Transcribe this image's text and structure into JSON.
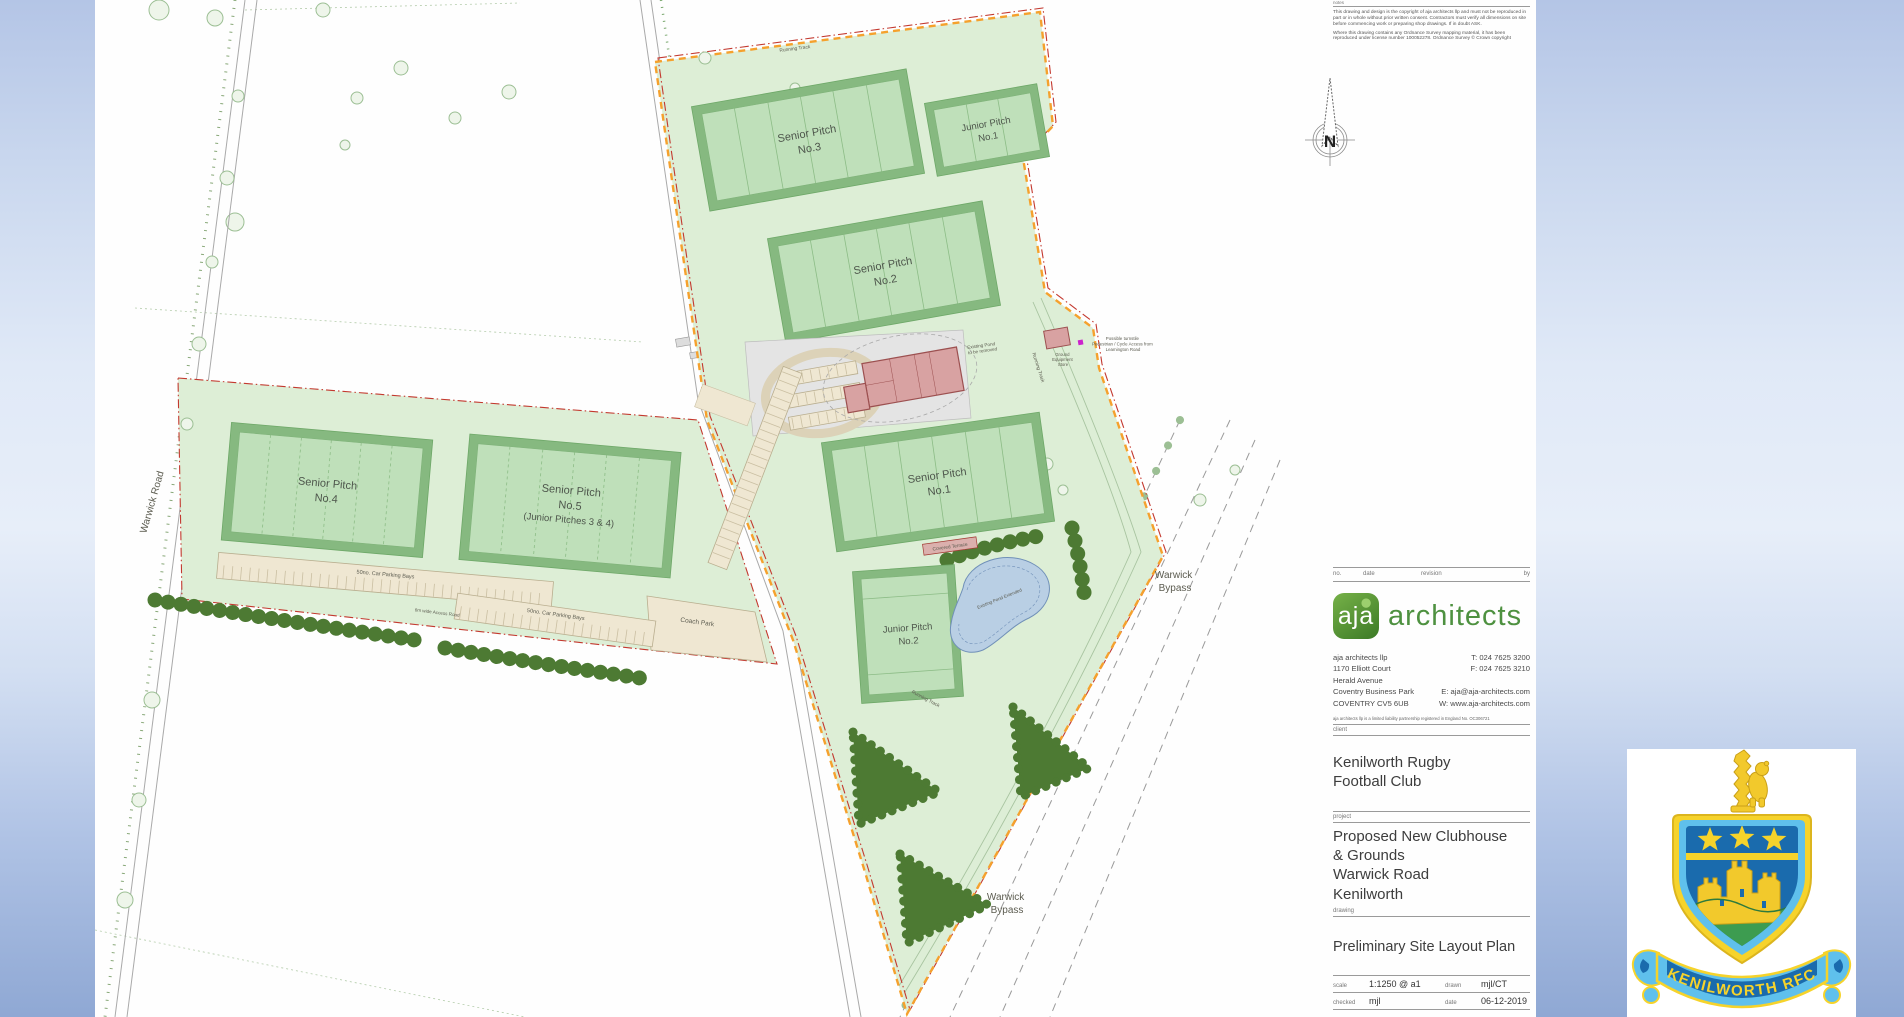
{
  "notes": {
    "label": "notes",
    "para1": "This drawing and design is the copyright of aja architects llp and must not be reproduced in part or in whole without prior written consent. Contractors must verify all dimensions on site before commencing work or preparing shop drawings. If in doubt ASK.",
    "para2": "Where this drawing contains any Ordnance Survey mapping material, it has been reproduced under license number 100052278. Ordnance Survey © Crown copyright"
  },
  "north_label": "N",
  "plan": {
    "pitches": [
      {
        "line1": "Senior Pitch",
        "line2": "No.3"
      },
      {
        "line1": "Junior Pitch",
        "line2": "No.1"
      },
      {
        "line1": "Senior Pitch",
        "line2": "No.2"
      },
      {
        "line1": "Senior Pitch",
        "line2": "No.1"
      },
      {
        "line1": "Junior Pitch",
        "line2": "No.2"
      },
      {
        "line1": "Senior Pitch",
        "line2": "No.4"
      },
      {
        "line1": "Senior Pitch",
        "line2": "No.5",
        "line3": "(Junior Pitches 3 & 4)"
      }
    ],
    "labels": {
      "warwick_road": "Warwick Road",
      "bypass_line1": "Warwick",
      "bypass_line2": "Bypass",
      "coach_park": "Coach Park",
      "parking_bays": "50no. Car Parking Bays",
      "access_road": "6m wide Access Road",
      "running_track": "Running Track",
      "covered_terrace": "Covered Terrace",
      "pond_extended": "Existing Pond Extended",
      "pond_removed_1": "Existing Pond",
      "pond_removed_2": "to be removed",
      "store_1": "Ground",
      "store_2": "Equipment",
      "store_3": "Store",
      "turnstile_1": "Possible turnstile",
      "turnstile_2": "Pedestrian / Cycle Access from",
      "turnstile_3": "Leamington Road"
    }
  },
  "titleblock": {
    "revision": {
      "no": "no.",
      "date": "date",
      "revision": "revision",
      "by": "by"
    },
    "logo": {
      "initials": "aja",
      "name": "architects"
    },
    "address_lines": [
      "aja architects llp",
      "1170 Elliott Court",
      "Herald Avenue",
      "Coventry Business Park",
      "COVENTRY CV5 6UB"
    ],
    "contact_lines": [
      "T: 024 7625 3200",
      "F: 024 7625 3210",
      "",
      "E: aja@aja-architects.com",
      "W: www.aja-architects.com"
    ],
    "registration": "aja architects llp is a limited liability partnership registered in England No. OC306721",
    "client_label": "client",
    "client_line1": "Kenilworth Rugby",
    "client_line2": "Football Club",
    "project_label": "project",
    "project_lines": [
      "Proposed New Clubhouse",
      "& Grounds",
      "Warwick Road",
      "Kenilworth"
    ],
    "drawing_label": "drawing",
    "drawing_title": "Preliminary Site Layout Plan",
    "scale_label": "scale",
    "scale_value": "1:1250 @ a1",
    "drawn_label": "drawn",
    "drawn_value": "mjl/CT",
    "checked_label": "checked",
    "checked_value": "mjl",
    "date_label": "date",
    "date_value": "06-12-2019",
    "no_label": "no."
  },
  "badge": {
    "banner_text": "KENILWORTH RFC"
  },
  "colors": {
    "aja_green": "#4e9140",
    "site_green": "#ddeed6",
    "pitch_green": "#bfe0ba",
    "pitch_band": "#86b980",
    "hedge_green": "#4d7a33",
    "boundary_orange": "#f5a12d",
    "boundary_red": "#c3392f",
    "pond_blue": "#b9cfe4",
    "building_pink": "#d8a2a2",
    "paving_tan": "#efe7d2",
    "badge_blue": "#5fc0ec",
    "badge_dark_blue": "#1a6bad",
    "badge_yellow": "#f6d32b",
    "badge_green": "#3d9c50"
  }
}
